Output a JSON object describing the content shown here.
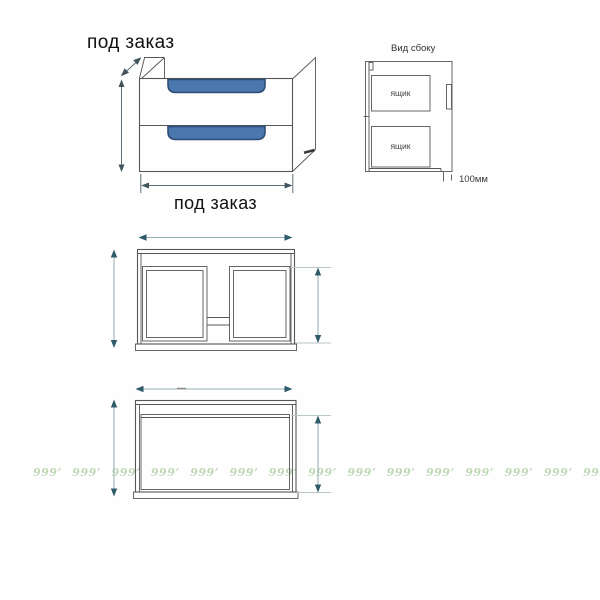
{
  "perspective_view": {
    "label_top": "под заказ",
    "label_bottom": "под заказ",
    "handle_color": "#4a77ae",
    "handle_border_color": "#2d4e74"
  },
  "side_view": {
    "title": "Вид сбоку",
    "drawer_top_label": "ящик",
    "drawer_bottom_label": "ящик",
    "offset_dimension": "100мм"
  },
  "watermark": {
    "pattern_text": "999’",
    "repeat_count": 19,
    "color": "#bed9b6"
  },
  "colors": {
    "line": "#565656",
    "dimension_line": "#93aeb4",
    "dimension_arrow_head": "#2f5b6b",
    "background": "#fefefe"
  }
}
